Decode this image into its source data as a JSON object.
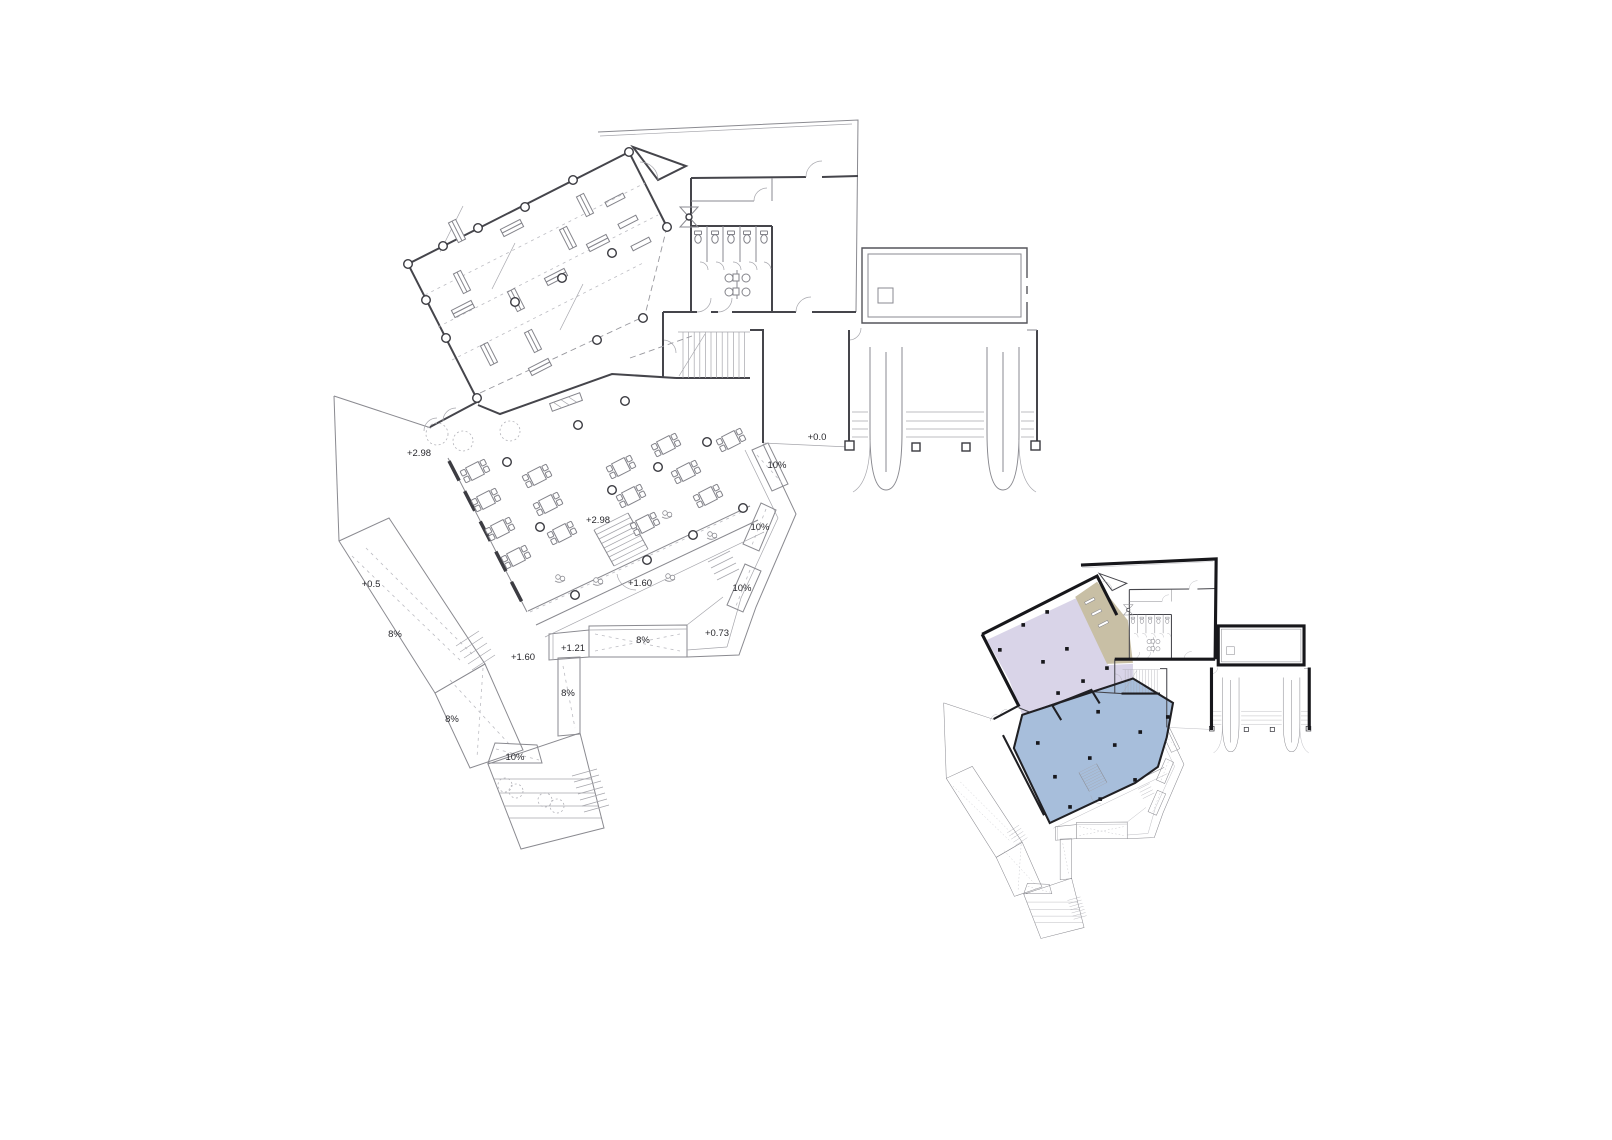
{
  "drawing": {
    "background": "#ffffff",
    "wall_color": "#45454b",
    "light_line_color": "#8a8a90",
    "key_wall_color": "#17171b"
  },
  "main_plan": {
    "labels": [
      {
        "type": "level",
        "text": "+2.98",
        "x": 419,
        "y": 456
      },
      {
        "type": "level",
        "text": "+2.98",
        "x": 598,
        "y": 523
      },
      {
        "type": "level",
        "text": "+0.0",
        "x": 817,
        "y": 440
      },
      {
        "type": "level",
        "text": "+0.5",
        "x": 371,
        "y": 587
      },
      {
        "type": "level",
        "text": "+1.60",
        "x": 640,
        "y": 586
      },
      {
        "type": "level",
        "text": "+1.60",
        "x": 523,
        "y": 660
      },
      {
        "type": "level",
        "text": "+1.21",
        "x": 573,
        "y": 651
      },
      {
        "type": "level",
        "text": "+0.73",
        "x": 717,
        "y": 636
      },
      {
        "type": "slope",
        "text": "8%",
        "x": 395,
        "y": 637
      },
      {
        "type": "slope",
        "text": "8%",
        "x": 643,
        "y": 643
      },
      {
        "type": "slope",
        "text": "8%",
        "x": 568,
        "y": 696
      },
      {
        "type": "slope",
        "text": "8%",
        "x": 452,
        "y": 722
      },
      {
        "type": "slope",
        "text": "10%",
        "x": 777,
        "y": 468
      },
      {
        "type": "slope",
        "text": "10%",
        "x": 760,
        "y": 530
      },
      {
        "type": "slope",
        "text": "10%",
        "x": 742,
        "y": 591
      },
      {
        "type": "slope",
        "text": "10%",
        "x": 515,
        "y": 760
      }
    ]
  },
  "key_plan": {
    "zones": [
      {
        "id": "zone-lavender",
        "color": "#d9d4e8"
      },
      {
        "id": "zone-blue",
        "color": "#a7bedb"
      },
      {
        "id": "zone-tan",
        "color": "#c8bfa5"
      }
    ]
  }
}
